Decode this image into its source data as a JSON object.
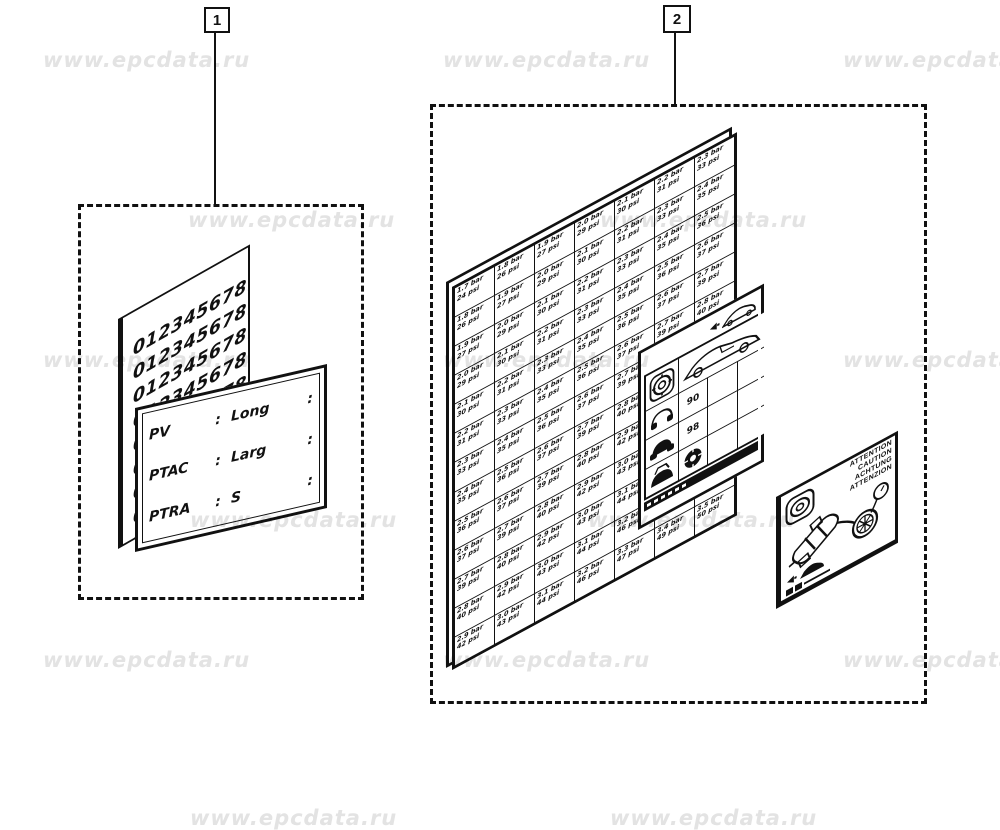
{
  "page": {
    "background": "#ffffff",
    "ink": "#111111"
  },
  "watermark": {
    "text": "www.epcdata.ru",
    "color": "#e3e3e3",
    "positions": [
      [
        43,
        48
      ],
      [
        443,
        48
      ],
      [
        843,
        48
      ],
      [
        188,
        208
      ],
      [
        600,
        208
      ],
      [
        43,
        348
      ],
      [
        443,
        348
      ],
      [
        843,
        348
      ],
      [
        190,
        508
      ],
      [
        588,
        508
      ],
      [
        43,
        648
      ],
      [
        443,
        648
      ],
      [
        843,
        648
      ],
      [
        190,
        806
      ],
      [
        610,
        806
      ]
    ]
  },
  "callouts": [
    {
      "label": "1"
    },
    {
      "label": "2"
    }
  ],
  "figure1": {
    "number_plate": {
      "digits_row": "0123456789",
      "rows": 9
    },
    "spec_plate": {
      "separator": ":",
      "rows": [
        {
          "label": "PV",
          "value": "Long"
        },
        {
          "label": "PTAC",
          "value": "Larg"
        },
        {
          "label": "PTRA",
          "value": "S"
        }
      ]
    }
  },
  "figure2": {
    "sticker_sheet": {
      "rows": 13,
      "cols": 7,
      "pressure_values": [
        {
          "bar": "1.7 bar",
          "psi": "24 psi"
        },
        {
          "bar": "1.8 bar",
          "psi": "26 psi"
        },
        {
          "bar": "1.9 bar",
          "psi": "27 psi"
        },
        {
          "bar": "2.0 bar",
          "psi": "29 psi"
        },
        {
          "bar": "2.1 bar",
          "psi": "30 psi"
        },
        {
          "bar": "2.2 bar",
          "psi": "31 psi"
        },
        {
          "bar": "2.3 bar",
          "psi": "33 psi"
        },
        {
          "bar": "2.4 bar",
          "psi": "35 psi"
        },
        {
          "bar": "2.5 bar",
          "psi": "36 psi"
        },
        {
          "bar": "2.6 bar",
          "psi": "37 psi"
        },
        {
          "bar": "2.7 bar",
          "psi": "39 psi"
        },
        {
          "bar": "2.8 bar",
          "psi": "40 psi"
        },
        {
          "bar": "2.9 bar",
          "psi": "42 psi"
        },
        {
          "bar": "3.0 bar",
          "psi": "43 psi"
        },
        {
          "bar": "3.1 bar",
          "psi": "44 psi"
        },
        {
          "bar": "3.2 bar",
          "psi": "46 psi"
        },
        {
          "bar": "3.3 bar",
          "psi": "47 psi"
        },
        {
          "bar": "3.4 bar",
          "psi": "49 psi"
        },
        {
          "bar": "3.5 bar",
          "psi": "50 psi"
        }
      ]
    },
    "placard": {
      "speed_values": [
        "90",
        "98"
      ]
    },
    "caution_label": {
      "words": [
        "ATTENTION",
        "CAUTION",
        "ACHTUNG",
        "ATTENZION"
      ]
    }
  }
}
